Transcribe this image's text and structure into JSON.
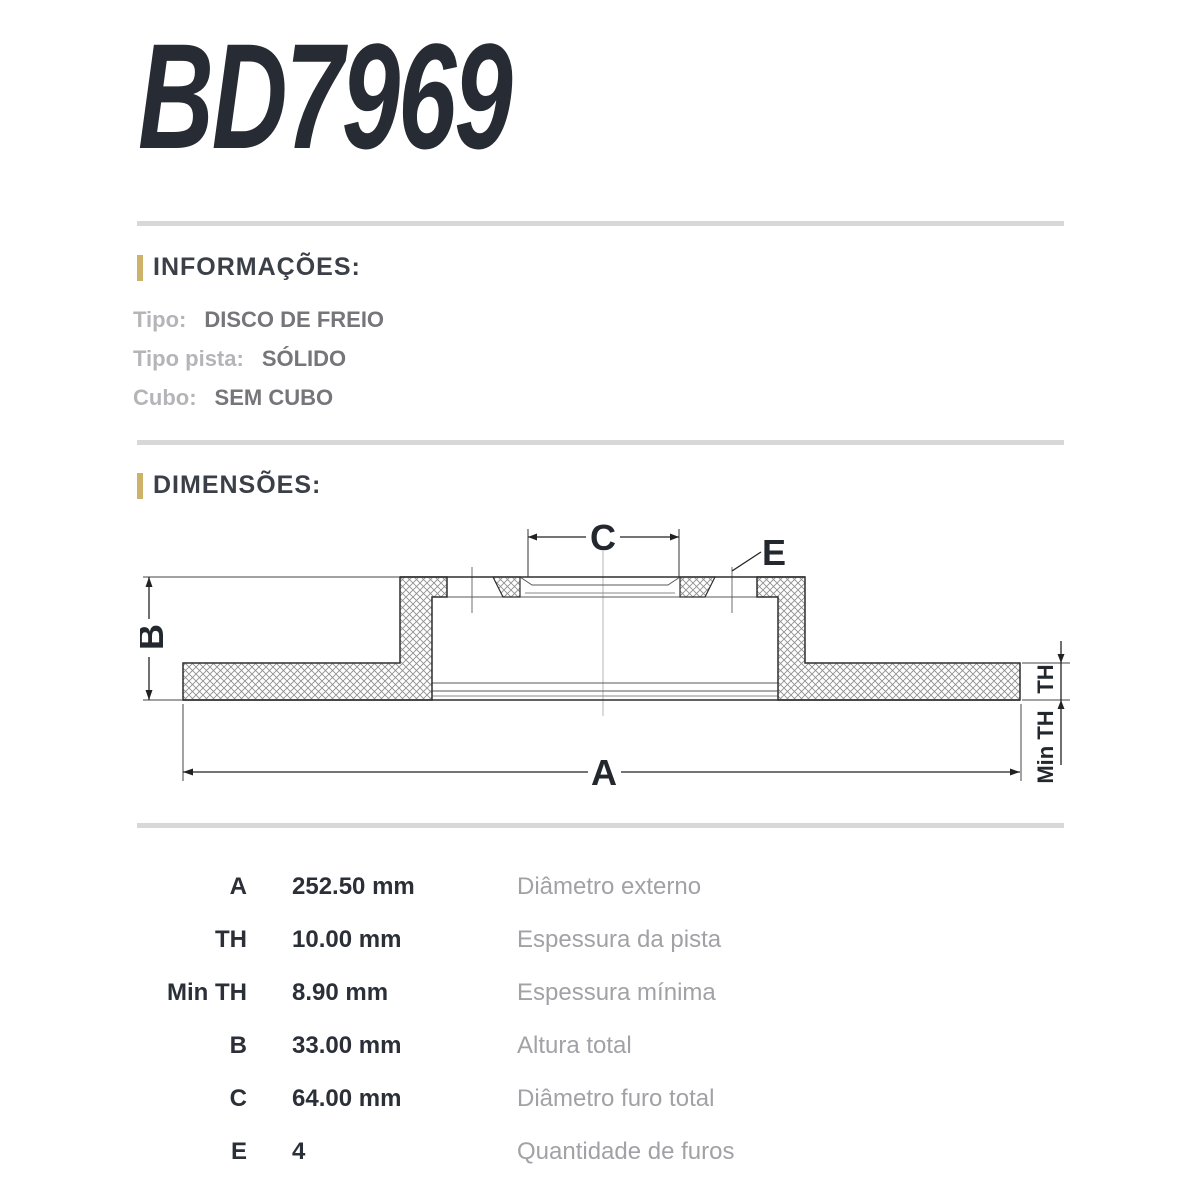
{
  "title": "BD7969",
  "colors": {
    "accent_bar": "#CDB269",
    "divider": "#D8D8D8",
    "heading_text": "#3B4048",
    "info_label": "#B5B5B9",
    "info_value": "#76767A",
    "table_text": "#2A2F38",
    "table_description": "#A2A2A6",
    "drawing_line": "#2F2F2F"
  },
  "info": {
    "heading": "INFORMAÇÕES:",
    "rows": [
      {
        "label": "Tipo:",
        "value": "DISCO DE FREIO"
      },
      {
        "label": "Tipo pista:",
        "value": "SÓLIDO"
      },
      {
        "label": "Cubo:",
        "value": "SEM CUBO"
      }
    ]
  },
  "dimensions": {
    "heading": "DIMENSÕES:",
    "drawing_labels": {
      "a": "A",
      "b": "B",
      "c": "C",
      "e": "E",
      "th": "TH",
      "min_th": "Min TH"
    },
    "rows": [
      {
        "label": "A",
        "value": "252.50 mm",
        "description": "Diâmetro externo"
      },
      {
        "label": "TH",
        "value": "10.00 mm",
        "description": "Espessura da pista"
      },
      {
        "label": "Min TH",
        "value": "8.90 mm",
        "description": "Espessura mínima"
      },
      {
        "label": "B",
        "value": "33.00 mm",
        "description": "Altura total"
      },
      {
        "label": "C",
        "value": "64.00 mm",
        "description": "Diâmetro furo total"
      },
      {
        "label": "E",
        "value": "4",
        "description": "Quantidade de furos"
      }
    ]
  }
}
